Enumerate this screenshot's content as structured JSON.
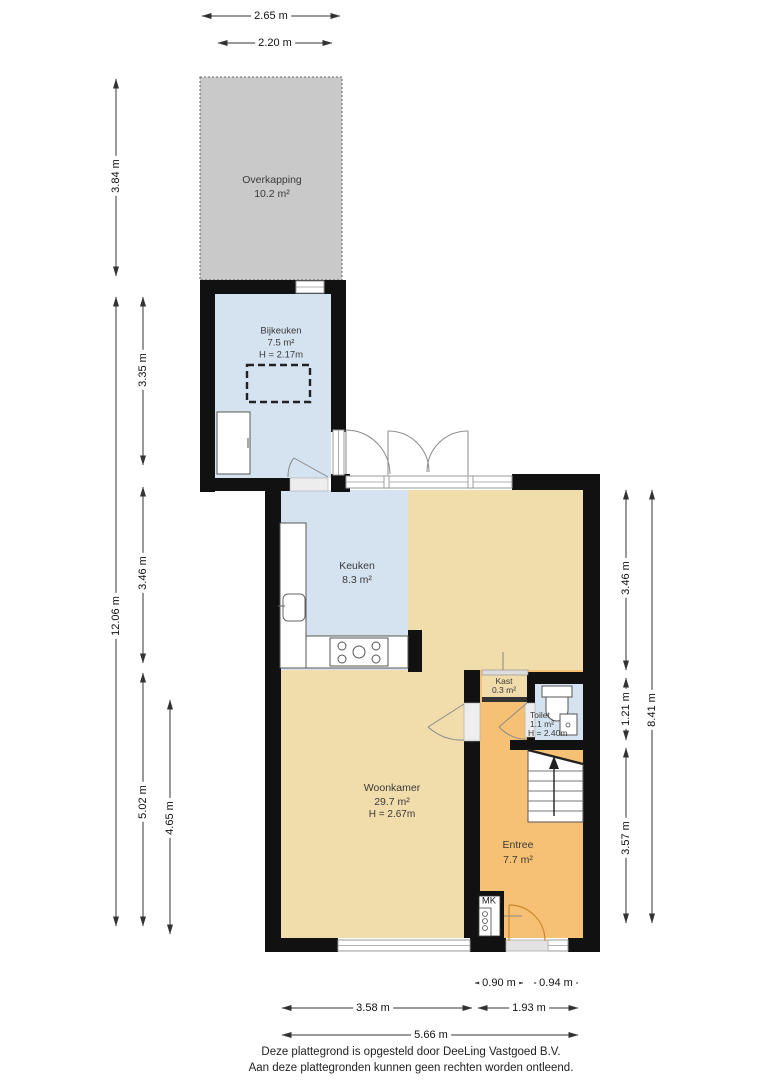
{
  "title": "Floor plan ground floor",
  "rooms": {
    "overkapping": {
      "name": "Overkapping",
      "area": "10.2 m²"
    },
    "bijkeuken": {
      "name": "Bijkeuken",
      "area": "7.5 m²",
      "height": "H = 2.17m"
    },
    "keuken": {
      "name": "Keuken",
      "area": "8.3 m²"
    },
    "woonkamer": {
      "name": "Woonkamer",
      "area": "29.7 m²",
      "height": "H = 2.67m"
    },
    "entree": {
      "name": "Entree",
      "area": "7.7 m²"
    },
    "kast": {
      "name": "Kast",
      "area": "0.3 m²"
    },
    "toilet": {
      "name": "Toilet",
      "area": "1.1 m²",
      "height": "H = 2.40m"
    },
    "meterkast": {
      "label": "MK"
    }
  },
  "dimensions": {
    "top": [
      "2.65 m",
      "2.20 m"
    ],
    "left": [
      "3.84 m",
      "3.35 m",
      "12.06 m",
      "3.46 m",
      "5.02 m",
      "4.65 m"
    ],
    "right": [
      "3.46 m",
      "1.21 m",
      "3.57 m",
      "8.41 m"
    ],
    "bottom": [
      "0.90 m",
      "0.94 m",
      "3.58 m",
      "1.93 m",
      "5.66 m"
    ]
  },
  "footer": {
    "line1": "Deze plattegrond is opgesteld door DeeLing Vastgoed B.V.",
    "line2": "Aan deze plattegronden kunnen geen rechten worden ontleend."
  },
  "colors": {
    "wall": "#111111",
    "room_blue": "#d5e2ef",
    "room_tan": "#f1dcab",
    "room_orange": "#f7c175",
    "overkapping_gray": "#c9c9c9",
    "door_arc": "#8a8a8a",
    "front_door_arc": "#c8882e"
  }
}
